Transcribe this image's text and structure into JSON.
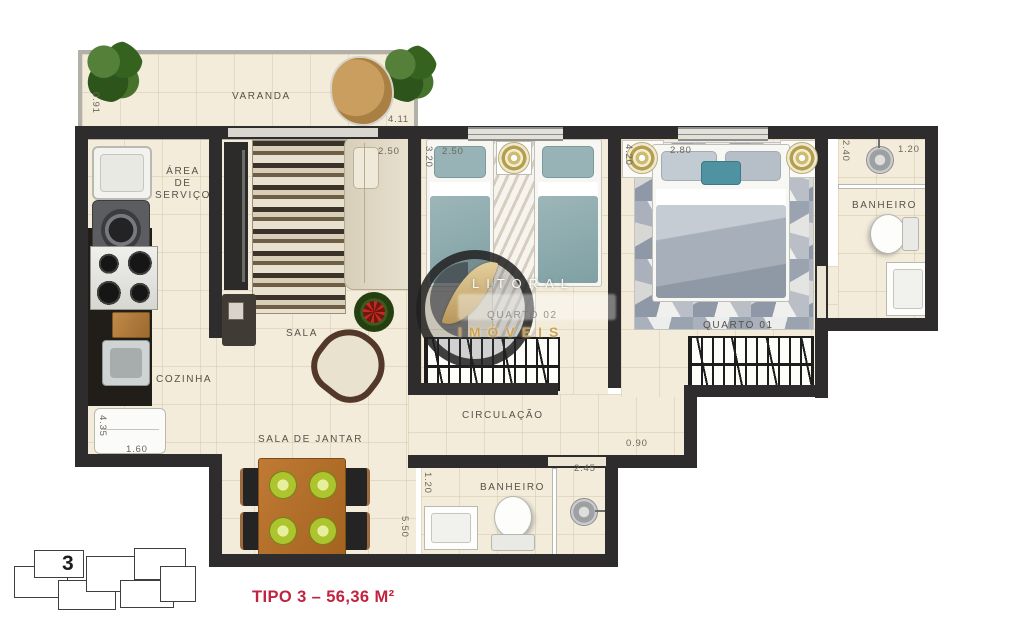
{
  "plan": {
    "rooms": {
      "varanda": "VARANDA",
      "area_servico": "ÁREA\nDE\nSERVIÇO",
      "cozinha": "COZINHA",
      "sala": "SALA",
      "sala_jantar": "SALA DE JANTAR",
      "circulacao": "CIRCULAÇÃO",
      "quarto02": "QUARTO 02",
      "quarto01": "QUARTO 01",
      "banheiro_suite": "BANHEIRO",
      "banheiro_social": "BANHEIRO"
    },
    "dimensions": {
      "varanda_depth": "0.91",
      "varanda_width": "4.11",
      "sala_width": "2.50",
      "quarto02_depth": "3.20",
      "quarto02_width": "2.50",
      "quarto01_depth": "4.20",
      "quarto01_width": "2.80",
      "banheiro_suite_depth": "2.40",
      "banheiro_suite_width": "1.20",
      "cozinha_depth": "4.35",
      "cozinha_width": "1.60",
      "jantar_depth": "5.50",
      "banheiro_social_depth": "1.20",
      "banheiro_social_width": "2.45",
      "circulacao_width": "0.90"
    }
  },
  "watermark": {
    "top": "LITORAL",
    "bottom": "IMÓVEIS"
  },
  "keyplan": {
    "unit_number": "3"
  },
  "footer": {
    "title": "TIPO 3 – 56,36 M²",
    "title_color": "#c12340"
  }
}
